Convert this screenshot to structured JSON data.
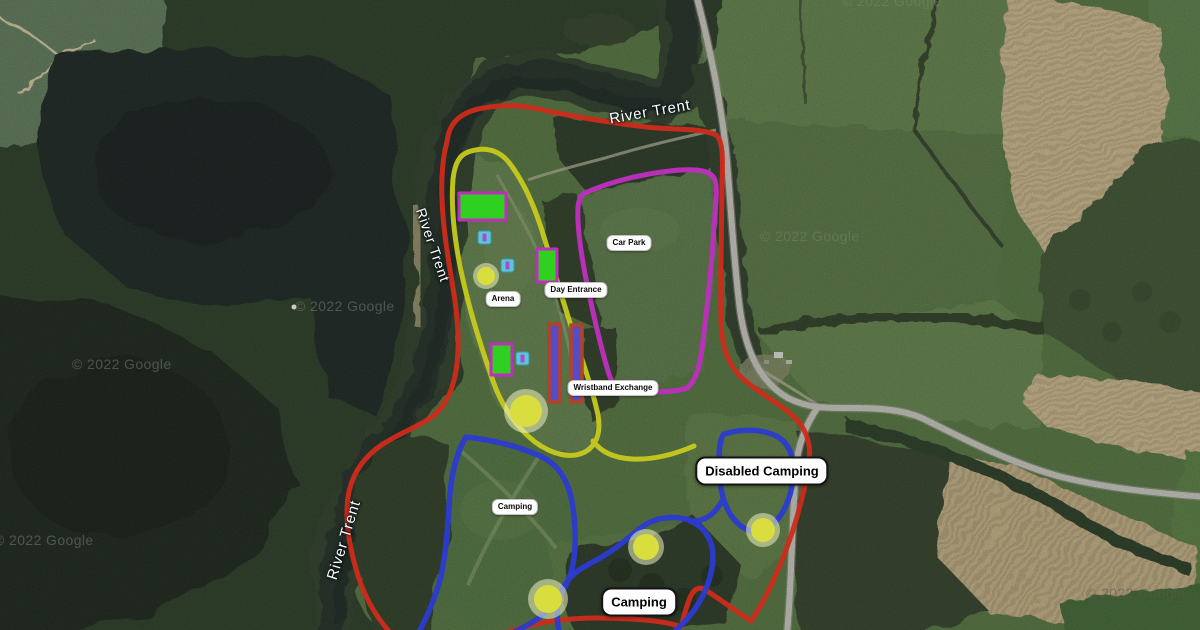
{
  "map": {
    "kind": "satellite-site-plan",
    "zones": {
      "car_park": "Car Park",
      "day_entrance": "Day Entrance",
      "arena": "Arena",
      "wristband_exchange": "Wristband Exchange",
      "camping_small": "Camping",
      "disabled_camping": "Disabled Camping",
      "camping_large": "Camping"
    },
    "river_labels": [
      "River Trent",
      "River Trent",
      "River Trent"
    ],
    "watermarks": [
      "© 2022 Google",
      "© 2022 Google",
      "© 2022 Google",
      "© 2022 Google",
      "© 2022 Google",
      "© 2022 Google"
    ],
    "colors": {
      "site_boundary": "#cf2b1a",
      "arena_boundary": "#c6c91d",
      "car_park_boundary": "#c02ec0",
      "camping_boundary": "#2b3bd0",
      "stage_block_fill": "#2fd01f",
      "gate_bar_fill": "#584cc6",
      "gate_bar_border": "#b14326",
      "marker_circle": "#d9dd3e",
      "facility_square": "#5fc4d8",
      "road": "#bdbdb5"
    }
  }
}
